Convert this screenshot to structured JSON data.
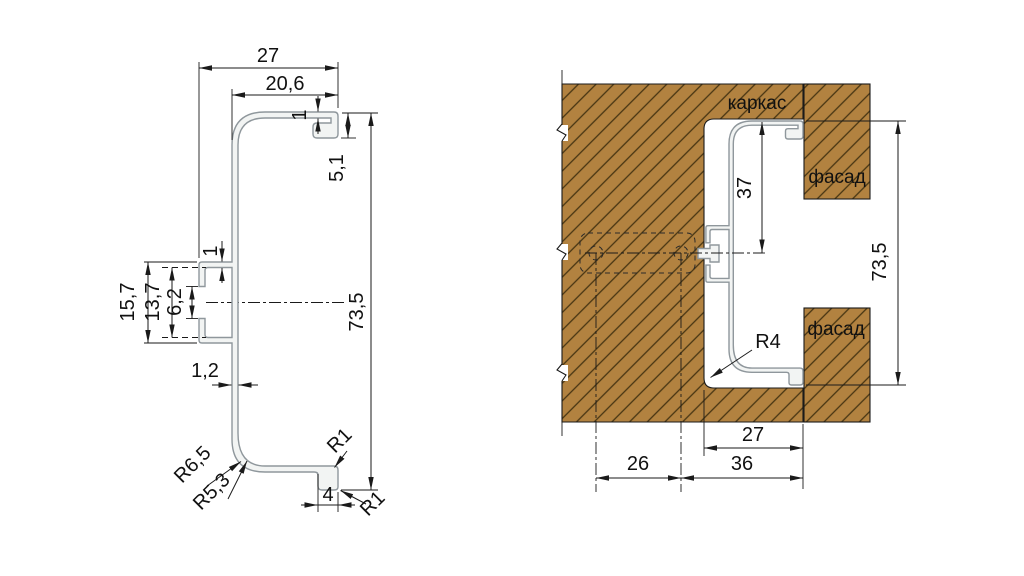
{
  "drawing": {
    "type": "technical-drawing",
    "subject": "aluminium C-shaped gola profile cross-section and installation view",
    "language": "ru"
  },
  "colors": {
    "wood_fill": "#b28240",
    "hatch_line": "#473512",
    "line": "#1a1a1a",
    "profile_stroke": "#8f979c",
    "profile_fill": "#f2f4f3"
  },
  "left_view": {
    "dims": {
      "overall_width": "27",
      "arm_width": "20,6",
      "lip_gap": "1",
      "lip_depth": "5,1",
      "overall_height": "73,5",
      "clip_height": "15,7",
      "clip_inner_height": "13,7",
      "clip_opening": "6,2",
      "clip_arm_thickness": "1",
      "wall_thickness": "1,2",
      "radius_outer": "R6,5",
      "radius_inner": "R5,3",
      "radius_top_foot": "R1",
      "foot_width": "4",
      "radius_bottom_foot": "R1"
    }
  },
  "right_view": {
    "labels": {
      "carcass": "каркас",
      "facade_top": "фасад",
      "facade_bottom": "фасад"
    },
    "dims": {
      "depth_to_axis": "37",
      "overall_height": "73,5",
      "corner_radius": "R4",
      "groove_width": "27",
      "axis_offset": "26",
      "edge_offset": "36"
    }
  }
}
